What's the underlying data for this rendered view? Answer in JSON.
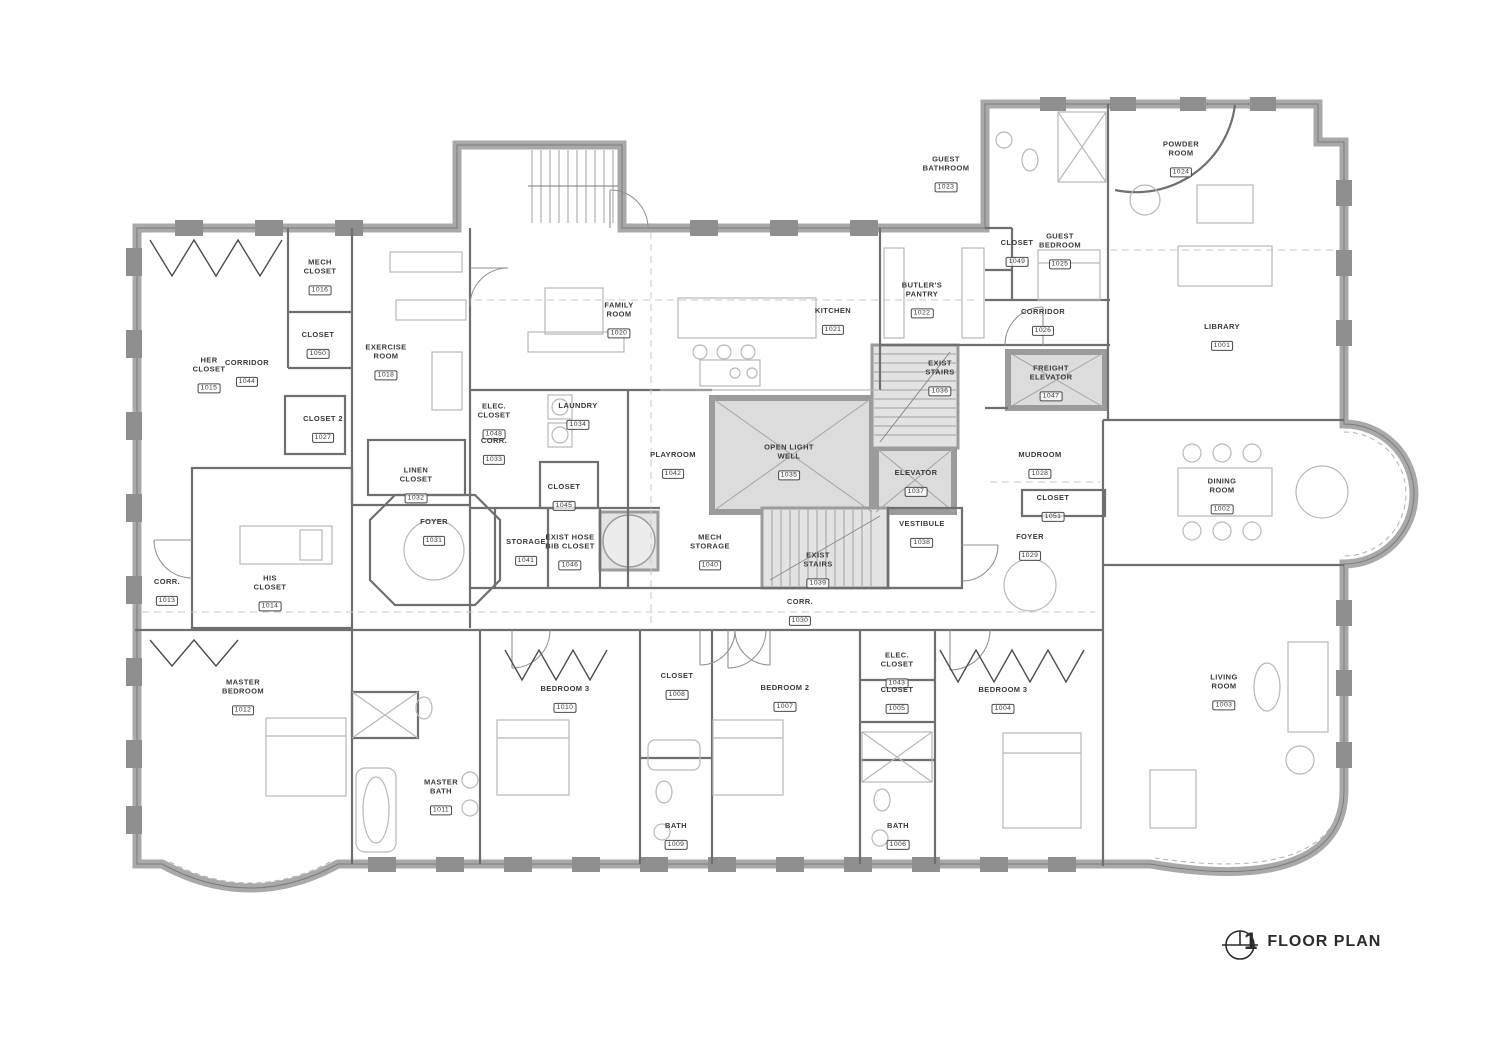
{
  "title_block": {
    "sheet_number": "1",
    "title": "FLOOR PLAN"
  },
  "colors": {
    "exterior_wall": "#a9a9a9",
    "interior_wall": "#6f6f6f",
    "core_fill": "#dcdcdc",
    "core_stroke": "#9b9b9b",
    "furniture": "#b8b8b8",
    "label_text": "#3a3a3a",
    "background": "#ffffff"
  },
  "rooms": [
    {
      "name": "HER\nCLOSET",
      "number": "1015",
      "x": 209,
      "y": 370
    },
    {
      "name": "CORRIDOR",
      "number": "1044",
      "x": 247,
      "y": 368
    },
    {
      "name": "MECH\nCLOSET",
      "number": "1016",
      "x": 320,
      "y": 272
    },
    {
      "name": "CLOSET",
      "number": "1050",
      "x": 318,
      "y": 340
    },
    {
      "name": "EXERCISE\nROOM",
      "number": "1018",
      "x": 386,
      "y": 357
    },
    {
      "name": "CLOSET 2",
      "number": "1027",
      "x": 323,
      "y": 424
    },
    {
      "name": "ELEC.\nCLOSET",
      "number": "1048",
      "x": 494,
      "y": 416
    },
    {
      "name": "CORR.",
      "number": "1033",
      "x": 494,
      "y": 446
    },
    {
      "name": "LAUNDRY",
      "number": "1034",
      "x": 578,
      "y": 411
    },
    {
      "name": "CLOSET",
      "number": "1045",
      "x": 564,
      "y": 492
    },
    {
      "name": "PLAYROOM",
      "number": "1042",
      "x": 673,
      "y": 460
    },
    {
      "name": "OPEN LIGHT\nWELL",
      "number": "1035",
      "x": 789,
      "y": 457
    },
    {
      "name": "FAMILY\nROOM",
      "number": "1020",
      "x": 619,
      "y": 315
    },
    {
      "name": "KITCHEN",
      "number": "1021",
      "x": 833,
      "y": 316
    },
    {
      "name": "BUTLER'S\nPANTRY",
      "number": "1022",
      "x": 922,
      "y": 295
    },
    {
      "name": "GUEST\nBATHROOM",
      "number": "1023",
      "x": 946,
      "y": 169
    },
    {
      "name": "CLOSET",
      "number": "1049",
      "x": 1017,
      "y": 248
    },
    {
      "name": "GUEST\nBEDROOM",
      "number": "1025",
      "x": 1060,
      "y": 246
    },
    {
      "name": "CORRIDOR",
      "number": "1026",
      "x": 1043,
      "y": 317
    },
    {
      "name": "POWDER\nROOM",
      "number": "1024",
      "x": 1181,
      "y": 154
    },
    {
      "name": "LIBRARY",
      "number": "1001",
      "x": 1222,
      "y": 332
    },
    {
      "name": "EXIST\nSTAIRS",
      "number": "1036",
      "x": 940,
      "y": 373
    },
    {
      "name": "FREIGHT\nELEVATOR",
      "number": "1047",
      "x": 1051,
      "y": 378
    },
    {
      "name": "ELEVATOR",
      "number": "1037",
      "x": 916,
      "y": 478
    },
    {
      "name": "MUDROOM",
      "number": "1028",
      "x": 1040,
      "y": 460
    },
    {
      "name": "CLOSET",
      "number": "1051",
      "x": 1053,
      "y": 503
    },
    {
      "name": "FOYER",
      "number": "1029",
      "x": 1030,
      "y": 542
    },
    {
      "name": "DINING\nROOM",
      "number": "1002",
      "x": 1222,
      "y": 491
    },
    {
      "name": "FOYER",
      "number": "1031",
      "x": 434,
      "y": 527
    },
    {
      "name": "STORAGE",
      "number": "1041",
      "x": 526,
      "y": 547
    },
    {
      "name": "EXIST HOSE\nBIB CLOSET",
      "number": "1046",
      "x": 570,
      "y": 547
    },
    {
      "name": "MECH\nSTORAGE",
      "number": "1040",
      "x": 710,
      "y": 547
    },
    {
      "name": "EXIST\nSTAIRS",
      "number": "1039",
      "x": 818,
      "y": 565
    },
    {
      "name": "VESTIBULE",
      "number": "1038",
      "x": 922,
      "y": 529
    },
    {
      "name": "CORR.",
      "number": "1030",
      "x": 800,
      "y": 607
    },
    {
      "name": "CORR.",
      "number": "1013",
      "x": 167,
      "y": 587
    },
    {
      "name": "HIS\nCLOSET",
      "number": "1014",
      "x": 270,
      "y": 588
    },
    {
      "name": "LINEN\nCLOSET",
      "number": "1032",
      "x": 416,
      "y": 480
    },
    {
      "name": "MASTER\nBEDROOM",
      "number": "1012",
      "x": 243,
      "y": 692
    },
    {
      "name": "MASTER\nBATH",
      "number": "1011",
      "x": 441,
      "y": 792
    },
    {
      "name": "BEDROOM 3",
      "number": "1010",
      "x": 565,
      "y": 694
    },
    {
      "name": "CLOSET",
      "number": "1008",
      "x": 677,
      "y": 681
    },
    {
      "name": "BATH",
      "number": "1009",
      "x": 676,
      "y": 831
    },
    {
      "name": "BEDROOM 2",
      "number": "1007",
      "x": 785,
      "y": 693
    },
    {
      "name": "ELEC.\nCLOSET",
      "number": "1043",
      "x": 897,
      "y": 665
    },
    {
      "name": "CLOSET",
      "number": "1005",
      "x": 897,
      "y": 695
    },
    {
      "name": "BEDROOM 3",
      "number": "1004",
      "x": 1003,
      "y": 695
    },
    {
      "name": "BATH",
      "number": "1006",
      "x": 898,
      "y": 831
    },
    {
      "name": "LIVING\nROOM",
      "number": "1003",
      "x": 1224,
      "y": 687
    }
  ]
}
